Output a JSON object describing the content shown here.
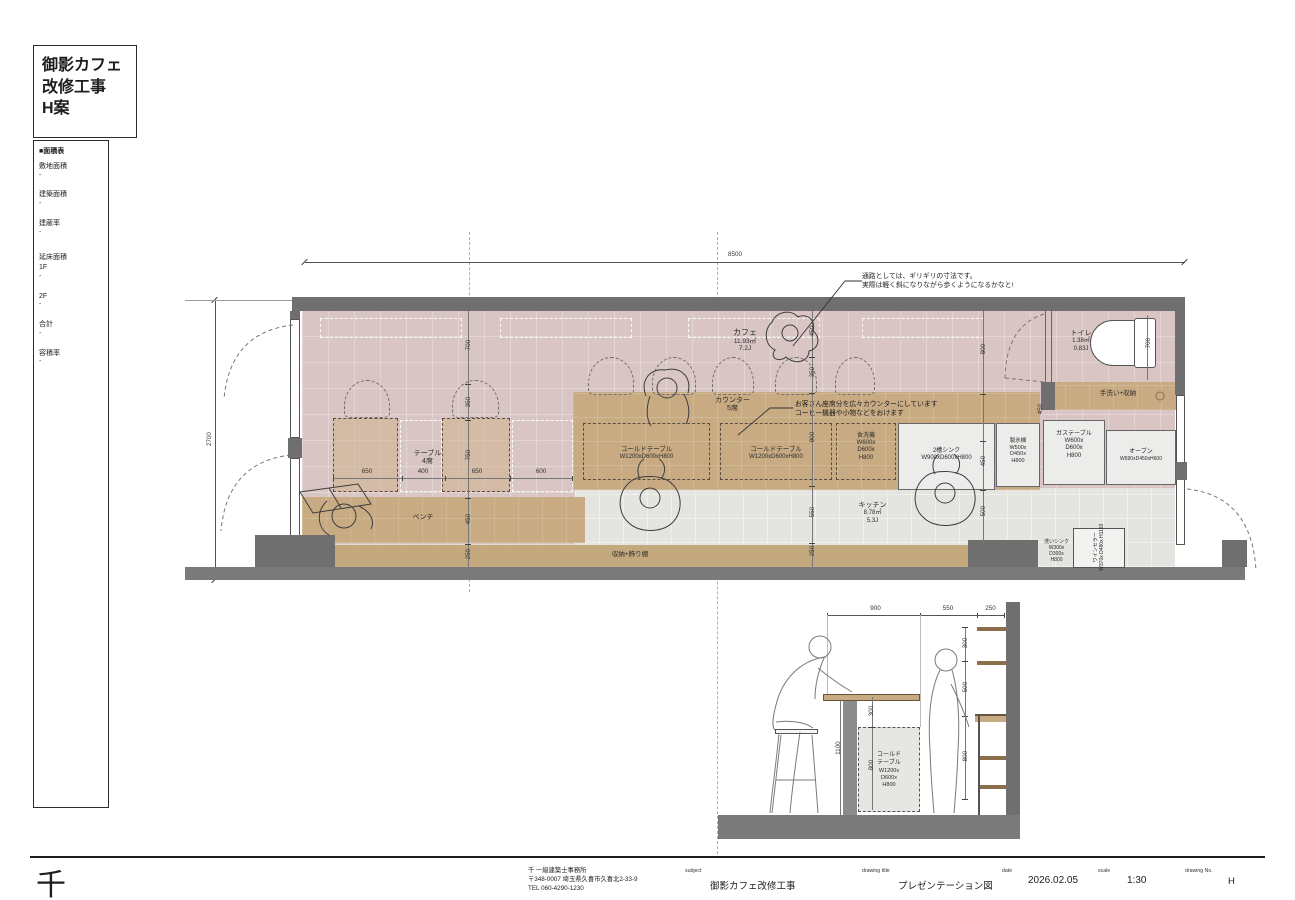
{
  "title_block": {
    "lines": [
      "御影カフェ",
      "改修工事",
      "H案"
    ]
  },
  "area_table": {
    "header": "■面積表",
    "rows": [
      {
        "label": "敷地面積",
        "value": "-"
      },
      {
        "label": "建築面積",
        "value": "-"
      },
      {
        "label": "建蔽率",
        "value": "-"
      },
      {
        "label": "延床面積",
        "value": ""
      },
      {
        "label": "1F",
        "value": "-"
      },
      {
        "label": "2F",
        "value": "-"
      },
      {
        "label": "合計",
        "value": "-"
      },
      {
        "label": "容積率",
        "value": "-"
      }
    ]
  },
  "plan": {
    "rooms": {
      "cafe": {
        "name": "カフェ",
        "area": "11.93㎡",
        "tatami": "7.2J"
      },
      "kitchen": {
        "name": "キッチン",
        "area": "8.78㎡",
        "tatami": "5.3J"
      },
      "toilet": {
        "name": "トイレ",
        "area": "1.38㎡",
        "tatami": "0.83J"
      }
    },
    "furniture": {
      "table": {
        "name": "テーブル",
        "seats": "4席"
      },
      "counter": {
        "name": "カウンター",
        "seats": "5席"
      },
      "bench": "ベンチ",
      "storage_shelf": "収納+飾り棚",
      "handwash": "手洗い+収納",
      "cold_table_1": {
        "name": "コールドテーブル",
        "size": "W1200xD600xH800"
      },
      "cold_table_2": {
        "name": "コールドテーブル",
        "size": "W1200xD600xH800"
      },
      "dishwasher": {
        "name": "食洗機",
        "s1": "W600x",
        "s2": "D600x",
        "s3": "H800"
      },
      "sink2": {
        "name": "2槽シンク",
        "size": "W900xD600xH800"
      },
      "ice_maker": {
        "name": "製氷機",
        "s1": "W500x",
        "s2": "D450x",
        "s3": "H800"
      },
      "gas_table": {
        "name": "ガステーブル",
        "s1": "W600x",
        "s2": "D600x",
        "s3": "H800"
      },
      "oven": {
        "name": "オーブン",
        "size": "W690xD450xH600"
      },
      "wash_sink": {
        "name": "洗いシンク",
        "s1": "W300x",
        "s2": "D300x",
        "s3": "H800"
      },
      "wine_cellar": {
        "name": "ワインセラー",
        "size": "W370x D480x H1160"
      }
    },
    "annotations": {
      "walkway1": "通路としては、ギリギリの寸法です。",
      "walkway2": "実際は軽く斜になりながら歩くようになるかなと!",
      "counter1": "お客さん座席分を広々カウンターにしています",
      "counter2": "コーヒー機器や小物などをおけます"
    },
    "dims": {
      "total_w": "8500",
      "total_h": "2700",
      "v1_700": "700",
      "v1_350": "350",
      "v1_750": "750",
      "v1_450": "450",
      "v1_250": "250",
      "h_650a": "650",
      "h_400": "400",
      "h_650b": "650",
      "h_600": "600",
      "v2_450": "450",
      "v2_350": "350",
      "v2_900": "900",
      "v2_550": "550",
      "v2_250": "250",
      "v3_800": "800",
      "v3_450": "450",
      "v3_500": "500",
      "hw_450": "450",
      "toilet_700": "700"
    }
  },
  "section": {
    "dims": {
      "top_900": "900",
      "top_550": "550",
      "top_250": "250",
      "right_300": "300",
      "right_500": "500",
      "right_800": "800",
      "counter_h": "1100",
      "mid_300": "300",
      "mid_800": "800"
    },
    "cold_table": {
      "n1": "コールド",
      "n2": "テーブル",
      "s1": "W1200x",
      "s2": "D600x",
      "s3": "H800"
    }
  },
  "title_bar": {
    "logo": "千",
    "office": "千 一級建築士事務所",
    "address": "〒348-0007 埼玉県久喜市久喜北2-33-9",
    "tel": "TEL 060-4290-1230",
    "subject_label": "subject",
    "subject": "御影カフェ改修工事",
    "drawing_title_label": "drawing title",
    "drawing_title": "プレゼンテーション図",
    "date_label": "date",
    "date": "2026.02.05",
    "scale_label": "scale",
    "scale": "1:30",
    "drawing_no_label": "drawing No.",
    "drawing_no": "H"
  }
}
